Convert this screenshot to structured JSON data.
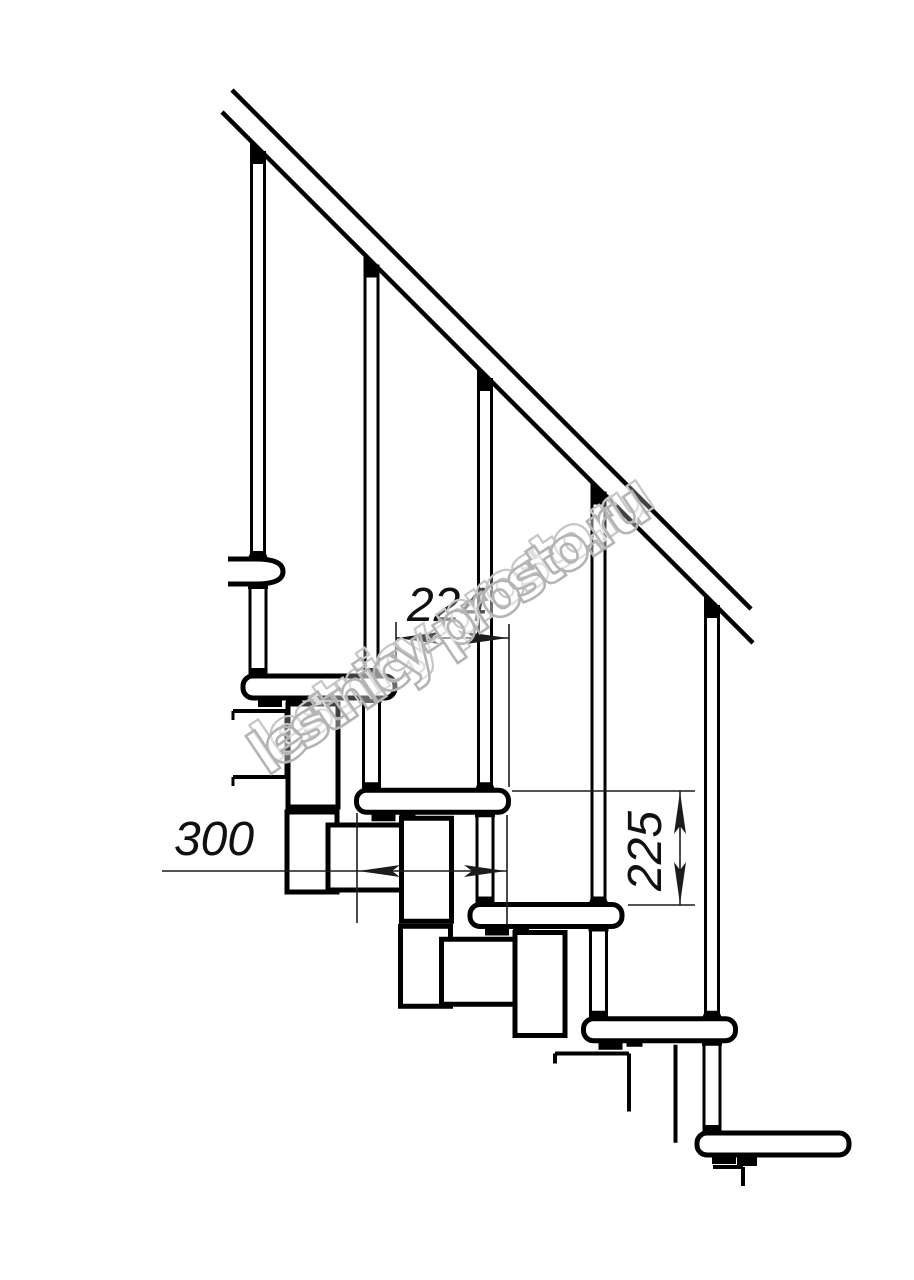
{
  "page": {
    "width": 914,
    "height": 1280,
    "background": "#ffffff",
    "ink": "#000000",
    "thin_ink": "#1c1c1c"
  },
  "watermark": {
    "text": "lestnicy-prosto.ru",
    "stroke_color": "#b4b4b4",
    "angle_deg": -34
  },
  "dimensions": [
    {
      "name": "step-run",
      "label": "224",
      "type": "horizontal",
      "line": {
        "x1": 396,
        "x2": 509,
        "y": 638
      },
      "extensions": [
        {
          "x": 396,
          "y1": 622,
          "y2": 661
        },
        {
          "x": 509,
          "y1": 624,
          "y2": 787
        }
      ],
      "arrows": [
        {
          "x": 397,
          "y": 638,
          "dir": "left"
        },
        {
          "x": 508,
          "y": 638,
          "dir": "right"
        }
      ],
      "text": {
        "x": 447,
        "y": 621,
        "rotate": 0
      }
    },
    {
      "name": "tread-depth",
      "label": "300",
      "type": "horizontal",
      "line": {
        "x1": 162,
        "x2": 507,
        "y": 871
      },
      "extensions": [
        {
          "x": 357,
          "y1": 813,
          "y2": 923
        },
        {
          "x": 507,
          "y1": 815,
          "y2": 925
        }
      ],
      "arrows": [
        {
          "x": 358,
          "y": 871,
          "dir": "left"
        },
        {
          "x": 506,
          "y": 871,
          "dir": "right"
        }
      ],
      "text": {
        "x": 214,
        "y": 855,
        "rotate": 0
      }
    },
    {
      "name": "riser-height",
      "label": "225",
      "type": "vertical",
      "line": {
        "x": 680,
        "y1": 791,
        "y2": 905
      },
      "extensions": [
        {
          "y": 791,
          "x1": 512,
          "x2": 695
        },
        {
          "y": 905,
          "x1": 628,
          "x2": 695
        }
      ],
      "arrows": [
        {
          "x": 680,
          "y": 792,
          "dir": "up"
        },
        {
          "x": 680,
          "y": 904,
          "dir": "down"
        }
      ],
      "text": {
        "x": 661,
        "y": 851,
        "rotate": -90
      }
    }
  ],
  "structure": {
    "rail": {
      "upper": [
        232,
        90,
        751,
        609
      ],
      "lower": [
        222,
        112,
        753,
        643
      ],
      "stroke": 4.5
    },
    "steps": {
      "count": 5,
      "dx": 113.5,
      "dy": 114.25,
      "tread": {
        "x0": 243,
        "y0": 676,
        "w": 152,
        "h": 22,
        "stroke": 5,
        "radius": 10
      }
    },
    "balusters": {
      "count": 5,
      "axis0": 258,
      "spacing": 113.5,
      "rail_offset": 111,
      "thin_half": 6.5,
      "sleeve_half": 8,
      "stroke": 3
    },
    "fragment_tread": {
      "x": 228,
      "y": 559,
      "w": 55,
      "h": 25
    },
    "floor_slab": {
      "x1": 233,
      "x2": 288,
      "y_top": 711,
      "y_bottom": 777
    },
    "modules": {
      "tall": [
        45,
        28,
        50,
        103
      ],
      "lower": [
        44,
        136,
        50,
        80
      ],
      "wide": [
        85,
        149,
        74,
        65
      ],
      "stroke": 5,
      "variants": [
        "full",
        "full",
        "tall-broken-wide",
        "broken-edge",
        "stub"
      ]
    }
  }
}
